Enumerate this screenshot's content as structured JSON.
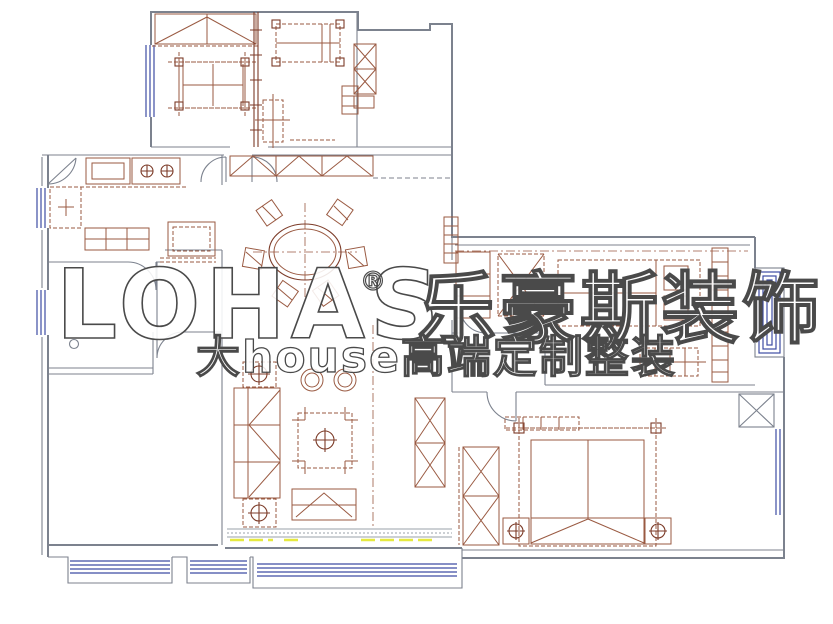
{
  "watermark": {
    "brand_latin": "LOHAS",
    "registered_mark": "®",
    "brand_cn": "乐豪斯装饰",
    "tagline": "大house高端定制整装"
  },
  "colors": {
    "wall": "#7c828e",
    "wall-dark": "#60666f",
    "furn": "#9a5a42",
    "furn-dark": "#7c3b28",
    "win": "#3e4ca4",
    "yellow": "#e6e93f",
    "wm": "#4a4a4a",
    "bg": "#ffffff"
  }
}
